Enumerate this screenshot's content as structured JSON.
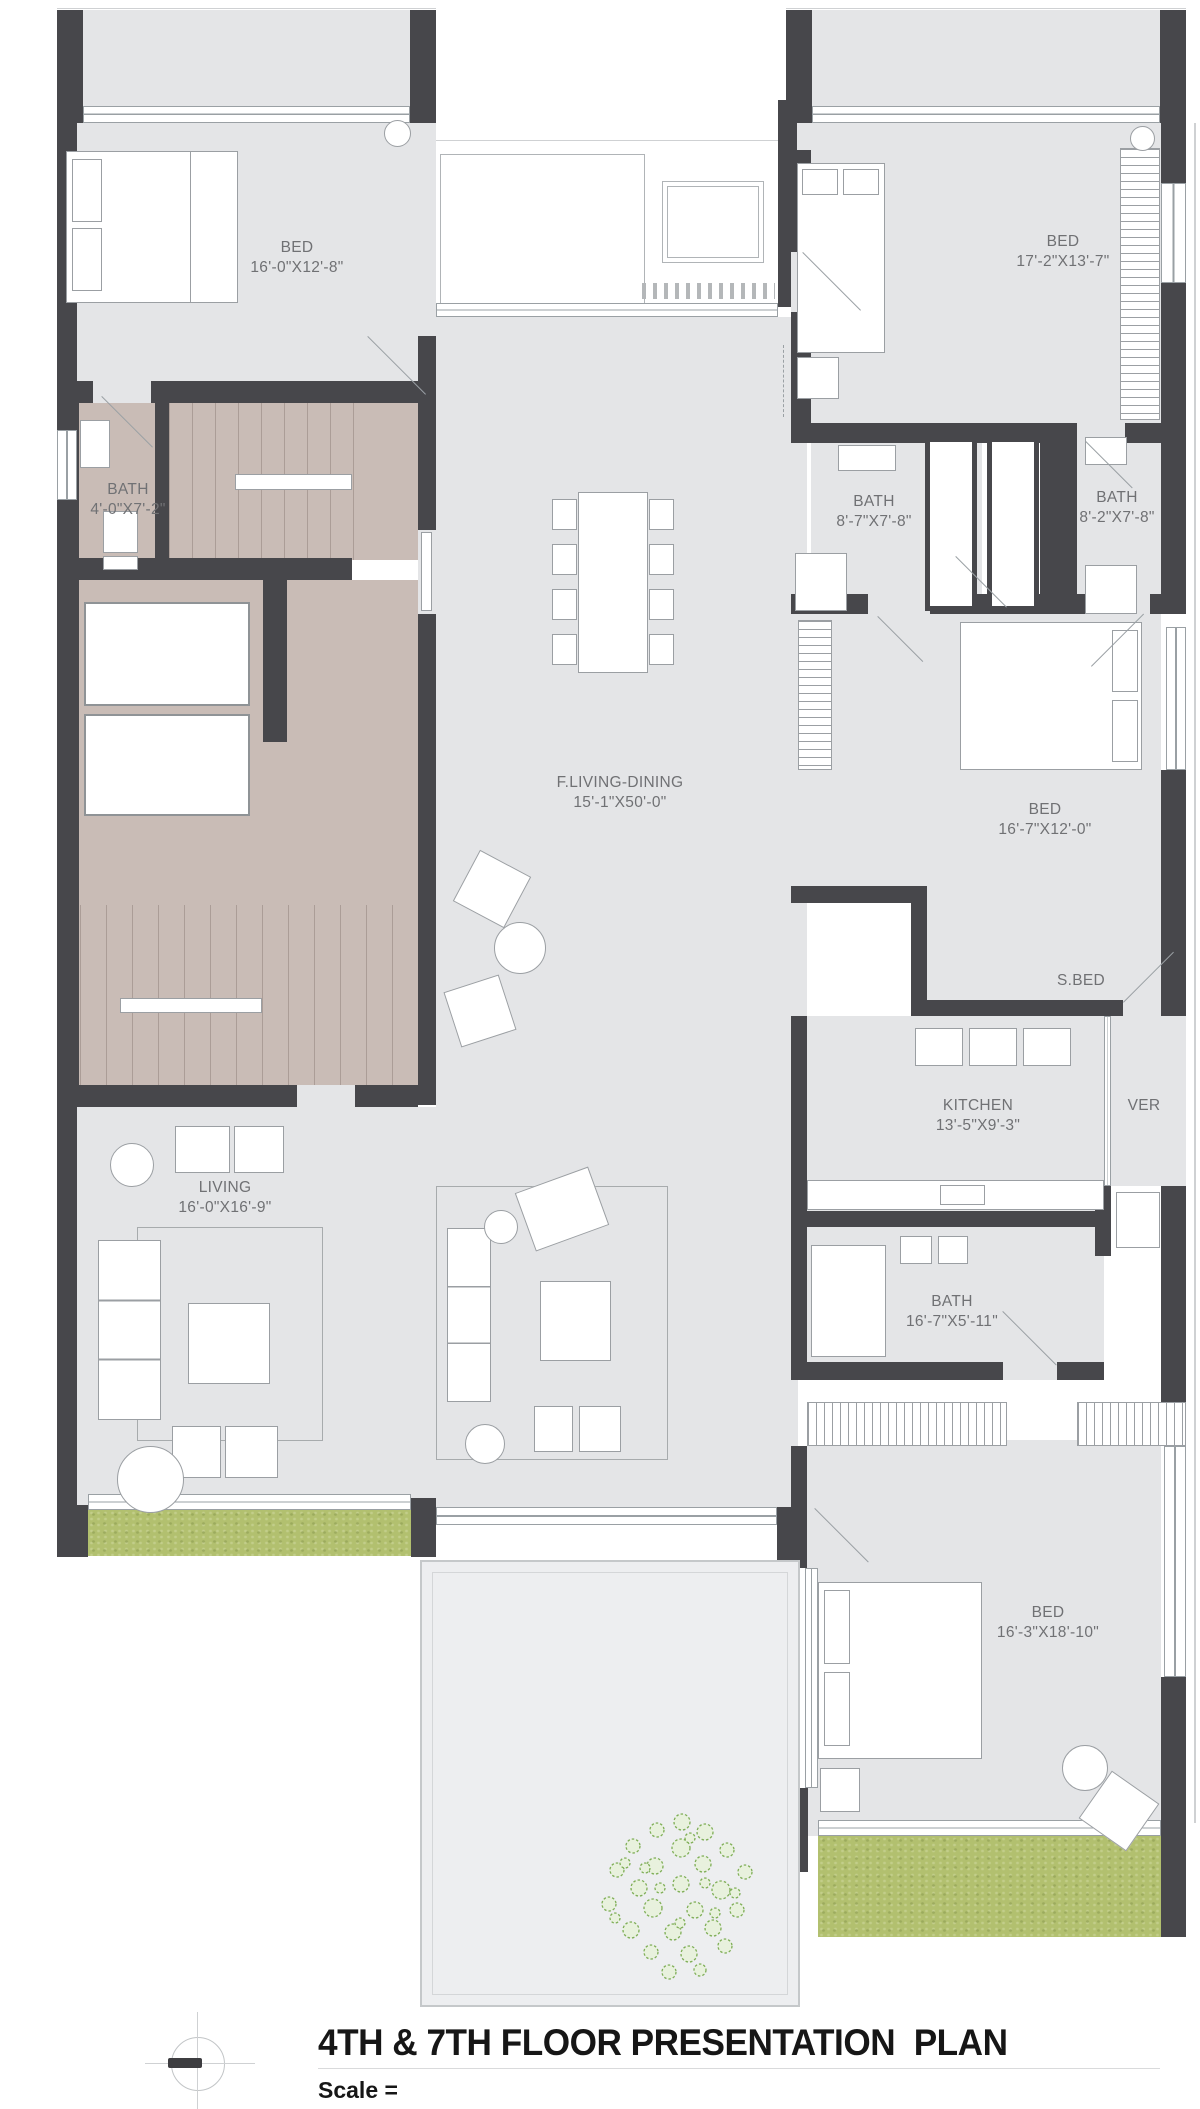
{
  "plan": {
    "title": "4TH & 7TH FLOOR PRESENTATION  PLAN",
    "scale_label": "Scale =",
    "rooms": [
      {
        "name": "BED",
        "dims": "16'-0\"X12'-8\""
      },
      {
        "name": "BED",
        "dims": "17'-2\"X13'-7\""
      },
      {
        "name": "BATH",
        "dims": "4'-0\"X7'-2\""
      },
      {
        "name": "BATH",
        "dims": "8'-7\"X7'-8\""
      },
      {
        "name": "BATH",
        "dims": "8'-2\"X7'-8\""
      },
      {
        "name": "F.LIVING-DINING",
        "dims": "15'-1\"X50'-0\""
      },
      {
        "name": "BED",
        "dims": "16'-7\"X12'-0\""
      },
      {
        "name": "S.BED",
        "dims": ""
      },
      {
        "name": "KITCHEN",
        "dims": "13'-5\"X9'-3\""
      },
      {
        "name": "VER",
        "dims": ""
      },
      {
        "name": "LIVING",
        "dims": "16'-0\"X16'-9\""
      },
      {
        "name": "BATH",
        "dims": "16'-7\"X5'-11\""
      },
      {
        "name": "BED",
        "dims": "16'-3\"X18'-10\""
      }
    ],
    "colors": {
      "wall": "#47474b",
      "floor": "#e4e5e7",
      "stair_core": "#c9bcb6",
      "grass": "#b2c06f",
      "tree": "#7fae57",
      "label_text": "#707174",
      "title_text": "#161616"
    }
  }
}
